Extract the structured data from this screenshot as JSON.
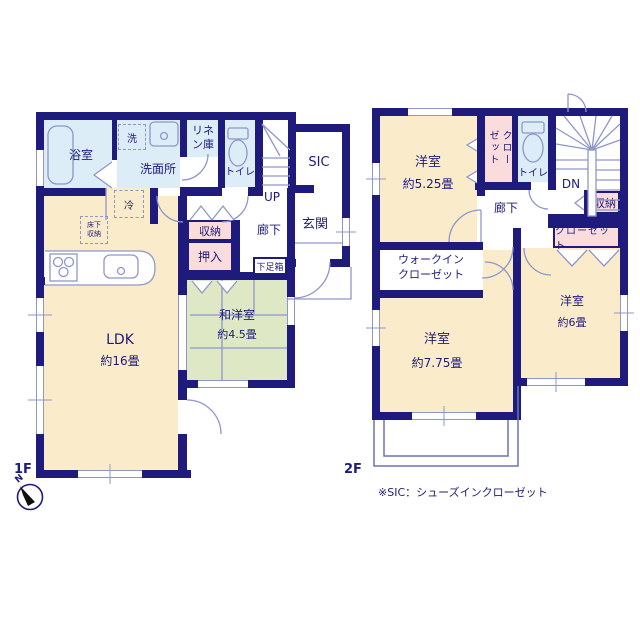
{
  "plan": {
    "labels": {
      "floor1": "1F",
      "floor2": "2F",
      "north": "N",
      "note": "※SIC：シューズインクローゼット"
    },
    "f1": {
      "bath": "浴室",
      "washer": "洗",
      "washroom": "洗面所",
      "linen": "リネン庫",
      "toilet": "トイレ",
      "stairs": "UP",
      "sic": "SIC",
      "entrance": "玄関",
      "hall": "廊下",
      "fridge": "冷",
      "underfloor": "床下収納",
      "storage": "収納",
      "oshiire": "押入",
      "shoebox": "下足箱",
      "ldk": "LDK",
      "ldk_size": "約16畳",
      "washitsu": "和洋室",
      "washitsu_size": "約4.5畳"
    },
    "f2": {
      "bed1": "洋室",
      "bed1_size": "約5.25畳",
      "closet1": "クローゼット",
      "toilet": "トイレ",
      "stairs": "DN",
      "storage": "収納",
      "closet2": "クローゼット",
      "hall": "廊下",
      "wic": "ウォークインクローゼット",
      "bed2": "洋室",
      "bed2_size": "約7.75畳",
      "bed3": "洋室",
      "bed3_size": "約6畳"
    },
    "colors": {
      "wall": "#1e1b7d",
      "room_cream": "#faecca",
      "water_blue": "#dcedf8",
      "tatami_green": "#dfe8c5",
      "closet_pink": "#f9dcdb",
      "fixture_line": "#8f96c9",
      "text_ink": "#1e1b7d"
    }
  }
}
